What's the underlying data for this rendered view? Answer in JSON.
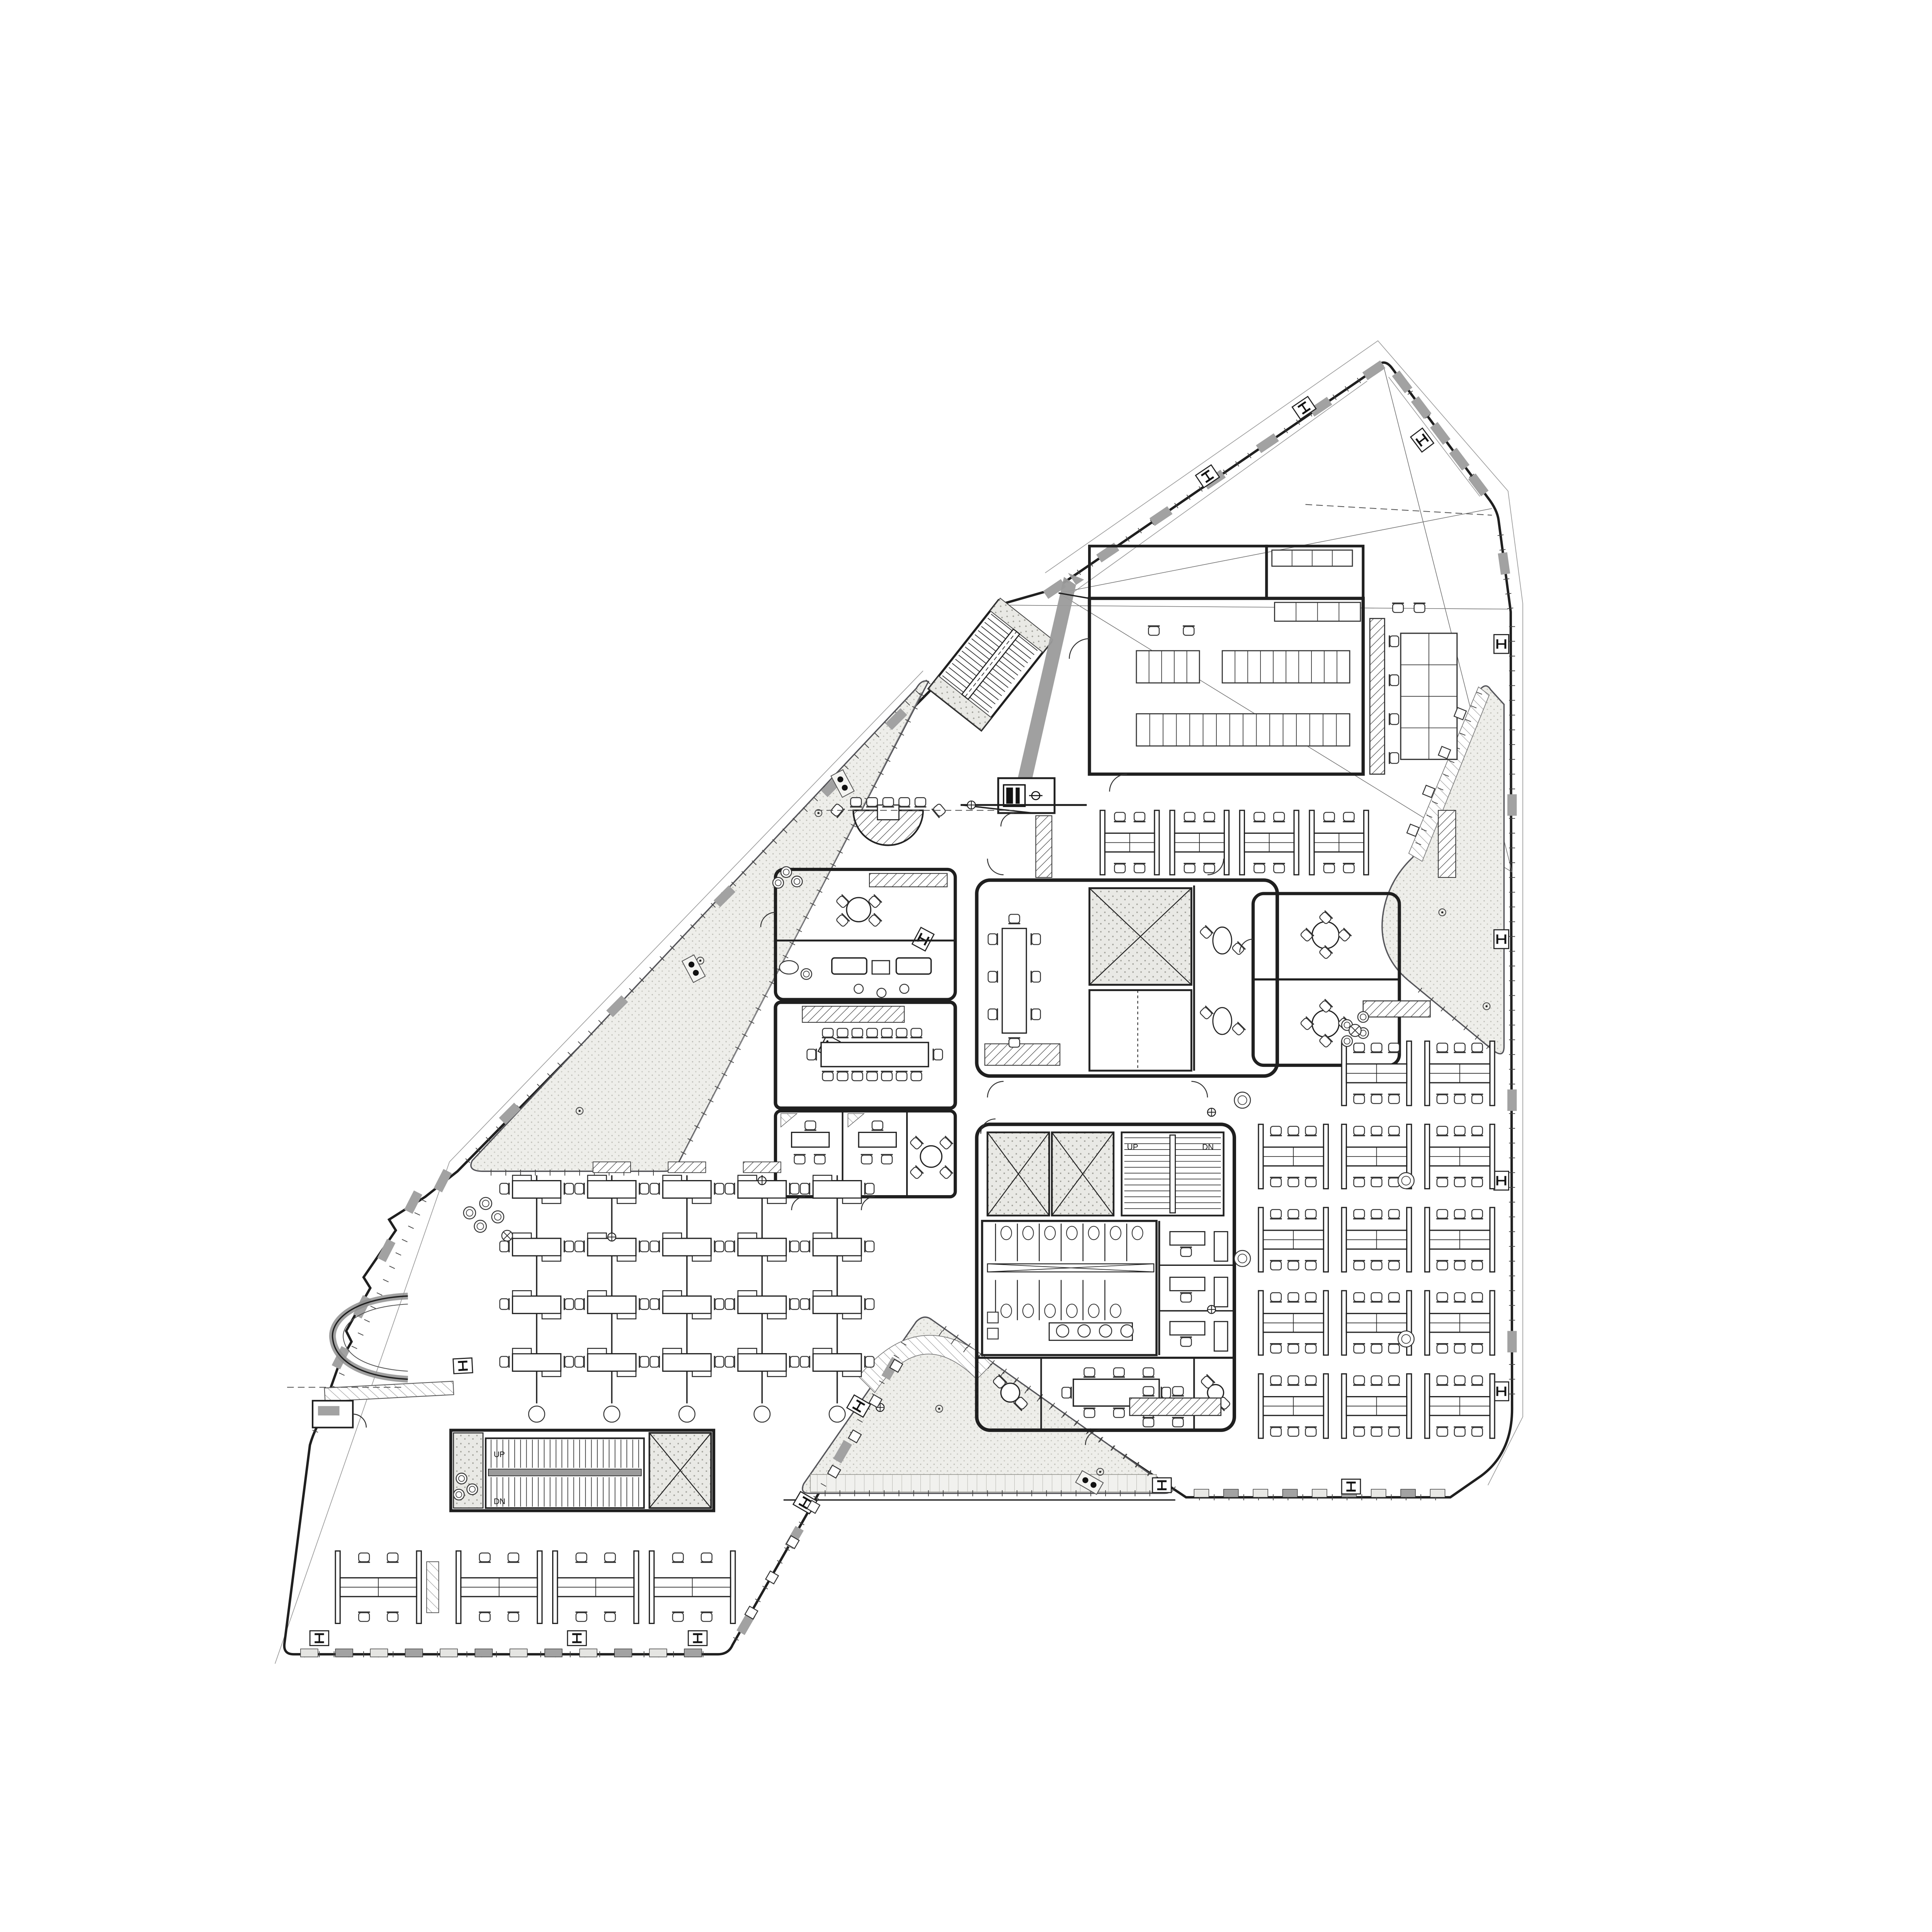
{
  "drawing": {
    "kind": "office building floor plan, CAD linework, black on white",
    "labels": {
      "up": "UP",
      "dn": "DN"
    },
    "colors": {
      "background": "#ffffff",
      "line": "#1f1f1f",
      "hairline": "#9a9a9a",
      "panel_gray": "#a2a2a2",
      "band_gray": "#9b9b9b",
      "terrace_fill": "#eeeeea",
      "terrace_dot": "#c2c2bb",
      "concrete_speckle": "#b9b9b2"
    },
    "areas": {
      "terrace_west": "triangular paved terrace",
      "terrace_east": "triangular paved terrace",
      "terrace_south": "triangular paved terrace",
      "canteen": "hall with two long segmented table rows",
      "kitchen": "servery counters and pantry grid",
      "core_upper": "meeting room, X-braced shafts, elevator lobby, huddle pods",
      "core_lower": "elevators, egress stair, restrooms, meeting rooms",
      "stair_feature": "diagonal feature stair with gray bridge band",
      "stair_south": "egress stair with X-braced shaft",
      "open_office_east": "grid of bench desk clusters, 5 rows",
      "open_office_west": "5 vertical bench desk rows",
      "open_office_south": "row of 4 bench desk clusters",
      "conference_west": "16-seat boardroom with credenza",
      "lounge_west": "sofa lounge, huddle rooms, curved banquette"
    },
    "symbols": {
      "column_marker": "boxed I-beam glyph",
      "floor_drain": "circled dot",
      "floor_box": "circled cross",
      "shaft": "rectangle with X diagonals",
      "chair": "rounded square with back rail",
      "plant": "concentric swirl circle"
    }
  }
}
